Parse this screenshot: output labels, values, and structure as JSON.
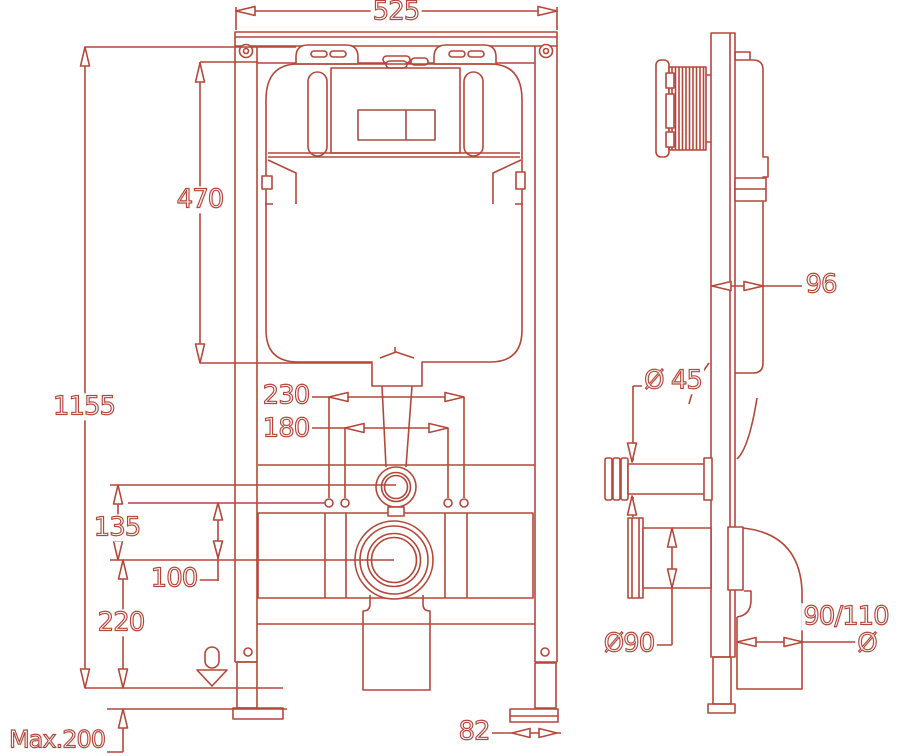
{
  "drawing_title": "concealed-cistern-frame-installation-drawing",
  "colors": {
    "line": "#b5473a",
    "plate_line": "#a34f41",
    "background": "#ffffff"
  },
  "front": {
    "frame_width": "525",
    "total_height": "1155",
    "cistern_height": "470",
    "bolt_spacing_outer": "230",
    "bolt_spacing_inner": "180",
    "flush_conn_height": "135",
    "offset_height": "100",
    "outlet_height": "220",
    "max_floor_distance": "Max.200",
    "foot_plate_width": "82"
  },
  "side": {
    "frame_depth": "96",
    "flush_pipe_dia": "Ø 45",
    "outlet_dia": "Ø90",
    "waste_pipe_dia": "90/110",
    "dia_symbol": "Ø"
  }
}
